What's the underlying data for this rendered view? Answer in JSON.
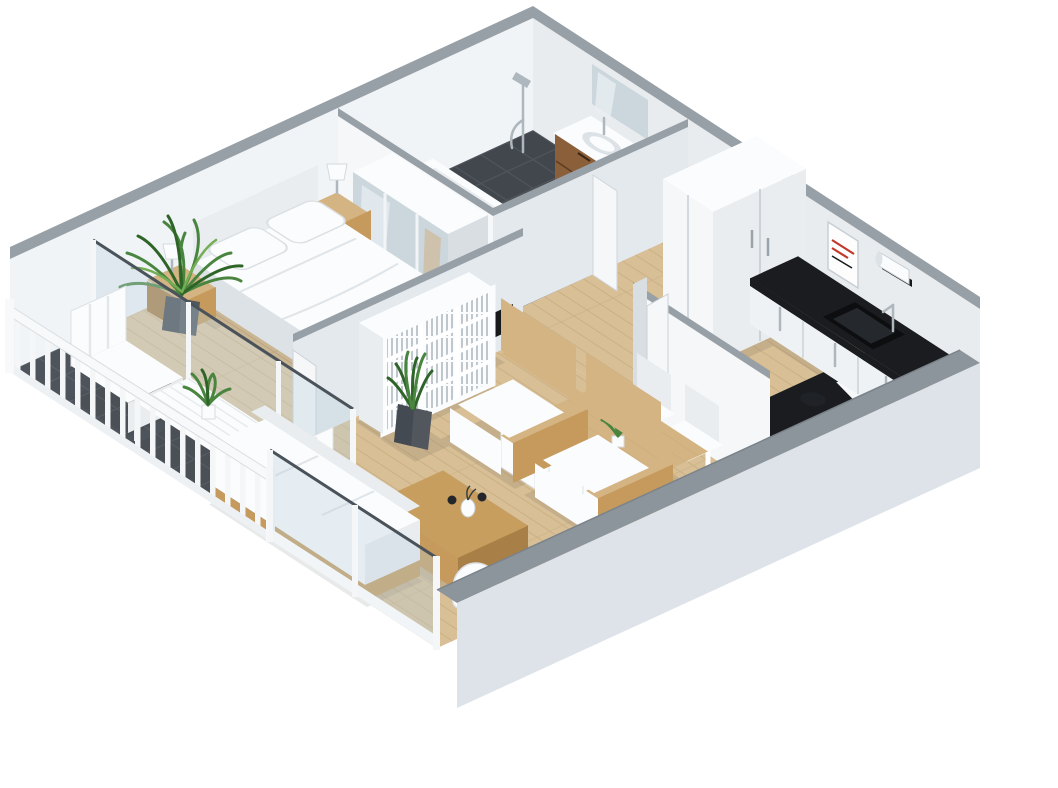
{
  "meta": {
    "title": "3D isometric cutaway floor plan of a one-bedroom apartment",
    "view": "isometric bird's-eye, walls cut away, white background"
  },
  "palette": {
    "bg": "#ffffff",
    "wallCap": "#98a0a7",
    "wallNw": "#f1f4f7",
    "wallNe": "#e8ecef",
    "wallInteriorLit": "#f5f7f9",
    "wallInteriorShade": "#e4e9ed",
    "wallEdge": "#d9dee3",
    "extWallFace": "#dde3e9",
    "extWallTop": "#8d959c",
    "floorWood": "#d8bf96",
    "floorBedroom": "#ddc69e",
    "plankLine": "#bb9d70",
    "tileDark": "#4e545b",
    "tileLine": "#6a7077",
    "bathFloor": "#42474e",
    "furnWhite": "#fbfcfd",
    "furnWhiteShade": "#e9edf0",
    "furnWhiteSide": "#dde2e7",
    "woodLight": "#d4b483",
    "woodMid": "#c59a5c",
    "woodDark": "#a87f46",
    "vanityWood": "#8a5f3a",
    "vanityWoodDark": "#73492a",
    "counterBlack": "#1a1c1f",
    "counterFace": "#eff2f5",
    "mirror": "#ccd7dd",
    "mirrorHi": "#e8eff3",
    "glass": "rgba(190,209,220,0.35)",
    "glassLine": "#4a525a",
    "chrome": "#aeb7bd",
    "plantGreen": "#4a8540",
    "plantDark": "#2f6428",
    "plantLight": "#74ad53",
    "potDark": "#2e3236",
    "potGray": "#51575d",
    "tvBlack": "#17191c",
    "bookSpine": "#b8c0c6",
    "posterRed": "#c0392b",
    "shadow": "#2b2f34"
  },
  "rooms": [
    {
      "name": "bedroom",
      "floor": "light-wood",
      "position": "top-left"
    },
    {
      "name": "bathroom",
      "floor": "dark-tile",
      "position": "top"
    },
    {
      "name": "hallway",
      "floor": "light-wood",
      "position": "center-top"
    },
    {
      "name": "kitchen",
      "floor": "light-wood",
      "position": "right"
    },
    {
      "name": "dining-area",
      "floor": "light-wood",
      "position": "center-right"
    },
    {
      "name": "living-room",
      "floor": "light-wood",
      "position": "center-bottom"
    },
    {
      "name": "balcony",
      "floor": "dark-tile",
      "position": "left"
    }
  ],
  "furniture": {
    "bedroom": [
      "double-bed-white-duvet",
      "headboard",
      "nightstand-left-with-lamp",
      "nightstand-right-with-lamp",
      "mirrored-sliding-wardrobe",
      "tall-potted-plant"
    ],
    "bathroom": [
      "bathtub",
      "wood-vanity-with-sink",
      "wall-mirror",
      "shower-fixture",
      "washer"
    ],
    "hallway": [
      "two-tall-white-closets",
      "open-doors"
    ],
    "kitchen": [
      "black-countertop-l-shape",
      "white-cabinet-fronts",
      "sink-with-faucet",
      "paper-towel-holder",
      "wall-poster",
      "kettle"
    ],
    "dining": [
      "wood-dining-table",
      "four-white-chairs",
      "small-table-plant"
    ],
    "living": [
      "white-cube-bookshelf-with-books",
      "wall-tv",
      "two-wood-frame-armchairs",
      "wood-coffee-table-with-vase",
      "daybed-sofa-white-cushion",
      "floor-lamp",
      "grass-plant-dark-pot",
      "plant-gray-faceted-pot"
    ],
    "balcony": [
      "white-railing-balusters",
      "white-bistro-table",
      "two-white-chairs",
      "potted-palm",
      "glass-partition"
    ]
  }
}
